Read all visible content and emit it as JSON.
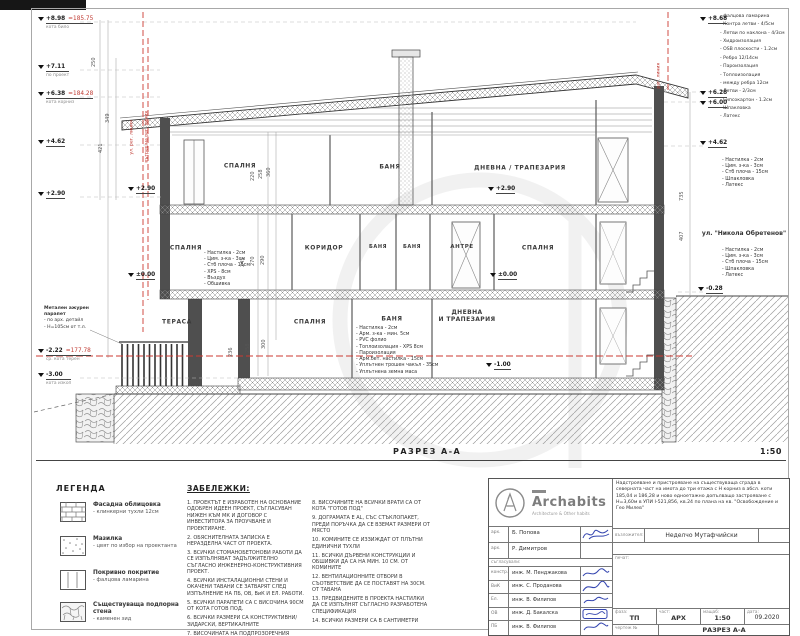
{
  "drawing": {
    "section_label": "РАЗРЕЗ А-А",
    "scale": "1:50",
    "street": "ул. \"Никола Обретенов\"",
    "rooms_top": [
      "СПАЛНЯ",
      "БАНЯ",
      "ДНЕВНА / ТРАПЕЗАРИЯ"
    ],
    "rooms_mid": [
      "СПАЛНЯ",
      "КОРИДОР",
      "БАНЯ",
      "БАНЯ",
      "АНТРЕ",
      "СПАЛНЯ"
    ],
    "rooms_low": [
      "ТЕРАСА",
      "СПАЛНЯ",
      "БАНЯ"
    ],
    "room_low_dnevna": [
      "ДНЕВНА",
      "И ТРАПЕЗАРИЯ"
    ],
    "roof_layers": [
      "- фалцова ламарина",
      "- Контра летви - 4/5см",
      "- Летви по наклона - 4/3см",
      "- Хидроизолация",
      "- OSB плоскости - 1.2см",
      "- Ребро 12/14см",
      "- Пароизолация",
      "- Топлоизолация",
      "- между ребра 12см",
      "- Летви - 2/3см",
      "- Гипсокартон - 1.2см",
      "- Шпакловка",
      "- Латекс"
    ],
    "slab_layers": [
      "- Настилка - 2см",
      "- Цим. з-ка - 3см",
      "- Стб плоча - 15см",
      "- Шпакловка",
      "- Латекс"
    ],
    "floor_layers_int": [
      "- Настилка - 2см",
      "- Цим. з-ка - 3см",
      "- Стб плоча - 15см",
      "- XPS - 8см",
      "- Въздух",
      "- Обшивка"
    ],
    "ground_layers": [
      "- Настилка - 2см",
      "- Арм. з-ка - мин. 5см",
      "- PVC фолио",
      "- Топлоизолация - XPS 8см",
      "- Пароизолация",
      "- Арм.бет. настилка - 15см",
      "- Уплътнен трошен чакъл - 35см",
      "- Уплътнена земна маса"
    ],
    "parapet_note": [
      "Метален ажурен",
      "парапет",
      "- по арх. детайл",
      "- Н=105см от т.л."
    ],
    "elevations_left": [
      {
        "value": "+8.98",
        "abs": "=185.75",
        "sub": "кота било"
      },
      {
        "value": "+7.11",
        "sub": "по проект"
      },
      {
        "value": "+6.38",
        "abs": "=184.28",
        "sub": "кота корниз"
      },
      {
        "value": "+4.62"
      },
      {
        "value": "+2.90"
      },
      {
        "value": "-2.22",
        "abs": "=177.78",
        "sub": "ср. кота терен"
      },
      {
        "value": "-3.00",
        "sub": "кота изкоп"
      }
    ],
    "elevations_right": [
      {
        "value": "+8.68"
      },
      {
        "value": "+6.28"
      },
      {
        "value": "+6.00"
      },
      {
        "value": "+4.62"
      },
      {
        "value": "-0.28"
      }
    ],
    "elevations_inner": [
      {
        "value": "+2.90"
      },
      {
        "value": "±0.00"
      },
      {
        "value": "-1.00"
      },
      {
        "value": "+2.90"
      },
      {
        "value": "±0.00"
      }
    ],
    "reg_line_labels": [
      "ул. рег. линия",
      "вътрешна рег. линия",
      "рег. линия"
    ],
    "dims": [
      "250",
      "349",
      "421",
      "220",
      "258",
      "360",
      "245",
      "270",
      "290",
      "236",
      "258",
      "300",
      "735",
      "407"
    ]
  },
  "legend": {
    "title": "ЛЕГЕНДА",
    "items": [
      {
        "name": "Фасадна облицовка",
        "desc": "- клинкерни тухли 12см"
      },
      {
        "name": "Мазилка",
        "desc": "- цвят по избор на проектанта"
      },
      {
        "name": "Покривно покритие",
        "desc": "- фалцова ламарина"
      },
      {
        "name": "Съществуваща подпорна стена",
        "desc": "- каменен зид"
      }
    ]
  },
  "notes": {
    "title": "ЗАБЕЛЕЖКИ:",
    "col1": [
      "1. ПРОЕКТЪТ Е ИЗРАБОТЕН НА ОСНОВАНИЕ ОДОБРЕН ИДЕЕН ПРОЕКТ, СЪГЛАСУВАН НИЖЕН КЪМ МК И ДОГОВОР С ИНВЕСТИТОРА ЗА ПРОУЧВАНЕ И ПРОЕКТИРАНЕ.",
      "2. ОБЯСНИТЕЛНАТА ЗАПИСКА Е НЕРАЗДЕЛНА ЧАСТ ОТ ПРОЕКТА.",
      "3. ВСИЧКИ СТОМАНОБЕТОНОВИ РАБОТИ ДА СЕ ИЗПЪЛНЯВАТ ЗАДЪЛЖИТЕЛНО СЪГЛАСНО ИНЖЕНЕРНО-КОНСТРУКТИВНИЯ ПРОЕКТ.",
      "4. ВСИЧКИ ИНСТАЛАЦИОННИ СТЕНИ И ОКАЧЕНИ ТАВАНИ СЕ ЗАТВАРЯТ СЛЕД ИЗПЪЛНЕНИЕ НА ПБ, ОВ, ВиК И ЕЛ. РАБОТИ.",
      "5. ВСИЧКИ ПАРАПЕТИ СА С ВИСОЧИНА 90СМ ОТ КОТА ГОТОВ ПОД.",
      "6. ВСИЧКИ РАЗМЕРИ СА КОНСТРУКТИВНИ/ЗИДАРСКИ, ВЕРТИКАЛНИТЕ",
      "7. ВИСОЧИНАТА НА ПОДПРОЗОРЕЧНИЯ ПАРАПЕТ Е ОТ \"КОТА ГОТОВ ПОД\""
    ],
    "col2": [
      "8. ВИСОЧИНИТЕ НА ВСИЧКИ ВРАТИ СА ОТ КОТА \"ГОТОВ ПОД\"",
      "9. ДОГРАМАТА Е AL, СЪС СТЪКЛОПАКЕТ, ПРЕДИ ПОРЪЧКА ДА СЕ ВЗЕМАТ РАЗМЕРИ ОТ МЯСТО",
      "10. КОМИНИТЕ СЕ ИЗЗИЖДАТ ОТ ПЛЪТНИ ЕДИНИЧНИ ТУХЛИ",
      "11. ВСИЧКИ ДЪРВЕНИ КОНСТРУКЦИИ И ОБШИВКИ ДА СА НА МИН. 10 СМ. ОТ КОМИНИТЕ",
      "12. ВЕНТИЛАЦИОННИТЕ ОТВОРИ В СЪОТВЕТСТВИЕ ДА СЕ ПОСТАВЯТ НА 30СМ. ОТ ТАВАНА",
      "13. ПРЕДВИДЕНИТЕ В ПРОЕКТА НАСТИЛКИ ДА СЕ ИЗПЪЛНЯТ СЪГЛАСНО РАЗРАБОТЕНА СПЕЦИФИКАЦИЯ",
      "14. ВСИЧКИ РАЗМЕРИ СА В САНТИМЕТРИ"
    ]
  },
  "titleblock": {
    "brand": "Archabits",
    "tagline": "Architecture & Other habits",
    "project": "Надстрояване и пристрояване на съществуваща сграда в северната част на имота до три етажа с Н корниз в абсл. коти 185,04 и 186,28 и ново едноетажно допълващо застрояване с Н=3,60м в УПИ I-521,856, кв.24 по плана на кв. \"Освобождение и Гео Милев\"",
    "client_label": "възложител:",
    "client": "Неделчо Мутафчийски",
    "stamp_label": "печат:",
    "approved_label": "съгласували:",
    "architects": [
      {
        "role": "арх.",
        "name": "Б. Попова"
      },
      {
        "role": "арх.",
        "name": "Р. Димитров"
      }
    ],
    "engineers": [
      {
        "role": "констр.",
        "name": "инж. М. Пенджакова"
      },
      {
        "role": "ВиК",
        "name": "инж. С. Проданова"
      },
      {
        "role": "Ел.",
        "name": "инж. В. Филипов"
      },
      {
        "role": "ОВ",
        "name": "инж. Д. Бакалска"
      },
      {
        "role": "ПБ",
        "name": "инж. В. Филипов"
      }
    ],
    "phase_label": "фаза:",
    "phase": "ТП",
    "part_label": "част:",
    "part": "АРХ",
    "scale_label": "мащаб:",
    "scale": "1:50",
    "date_label": "дата:",
    "date": "09.2020",
    "sheet_label": "чертеж №",
    "sheet_name": "РАЗРЕЗ А-А"
  }
}
